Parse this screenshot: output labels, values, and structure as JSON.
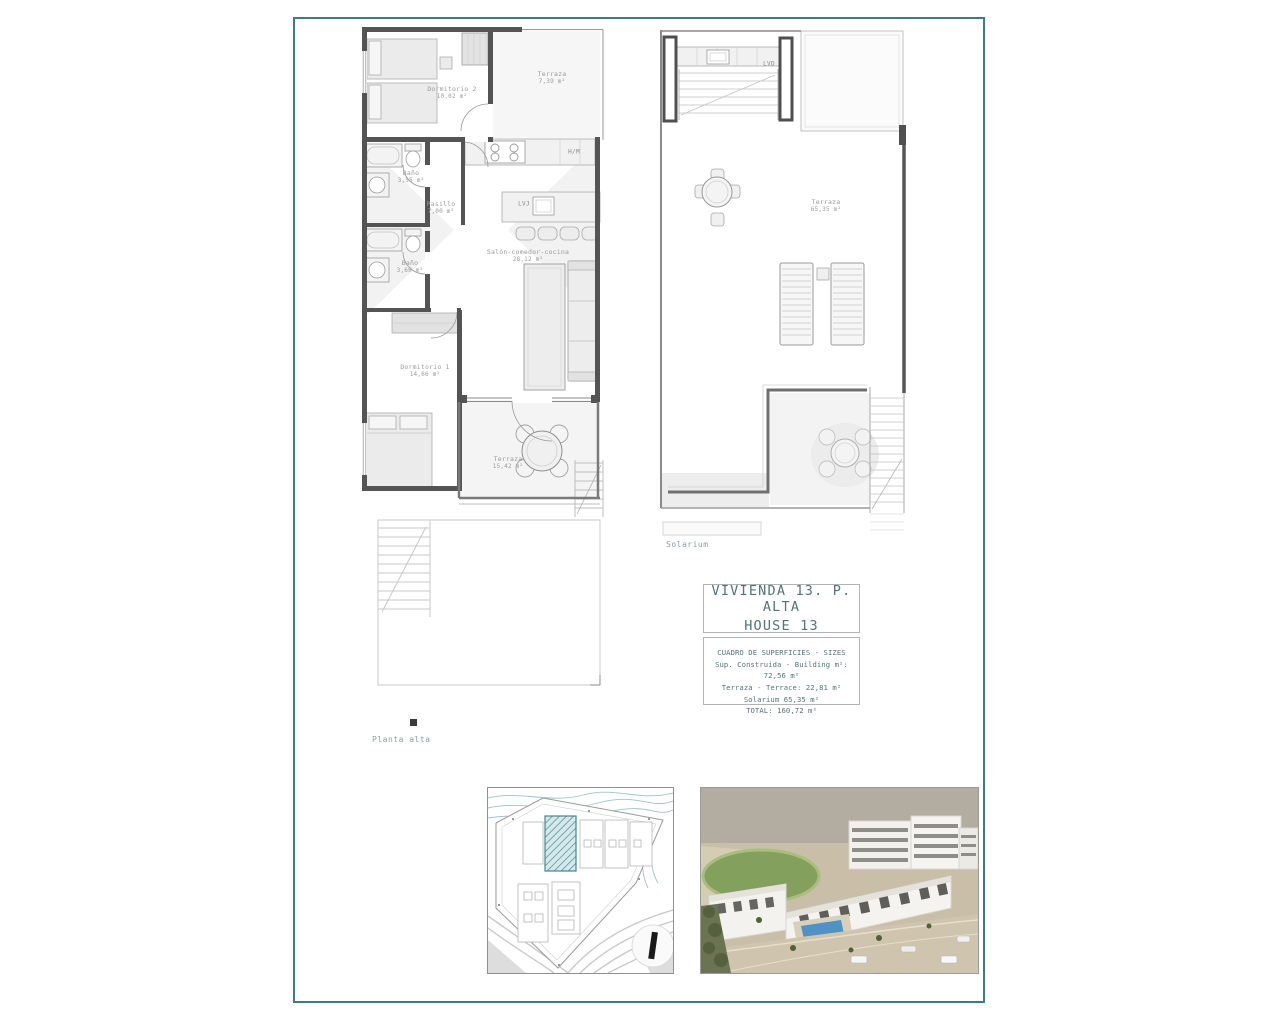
{
  "sheet": {
    "frame_color": "#3a7d85"
  },
  "plans": {
    "left": {
      "caption": "Planta alta",
      "rooms": [
        {
          "name": "Dormitorio 2",
          "area": "10,02 m²"
        },
        {
          "name": "Terraza",
          "area": "7,39 m²"
        },
        {
          "name": "Baño",
          "area": "3,55 m²"
        },
        {
          "name": "Pasillo",
          "area": "7,00 m²"
        },
        {
          "name": "Baño",
          "area": "3,60 m²"
        },
        {
          "name": "Salón-comedor-cocina",
          "area": "28,12 m²"
        },
        {
          "name": "Dormitorio 1",
          "area": "14,66 m²"
        },
        {
          "name": "Terraza",
          "area": "15,42 m²"
        }
      ],
      "annotations": {
        "washer": "H/M",
        "dishwasher": "LVJ"
      }
    },
    "right": {
      "caption": "Solarium",
      "rooms": [
        {
          "name": "Terraza",
          "area": "65,35 m²"
        }
      ],
      "annotations": {
        "laundry": "LVD"
      }
    }
  },
  "title_block": {
    "line1": "VIVIENDA 13. P. ALTA",
    "line2": "HOUSE 13",
    "table_title": "CUADRO DE SUPERFICIES  - SIZES",
    "rows": [
      "Sup. Construida - Building m²: 72,56 m²",
      "Terraza - Terrace: 22,81 m²",
      "Solarium 65,35 m²",
      "TOTAL: 160,72 m²"
    ]
  }
}
